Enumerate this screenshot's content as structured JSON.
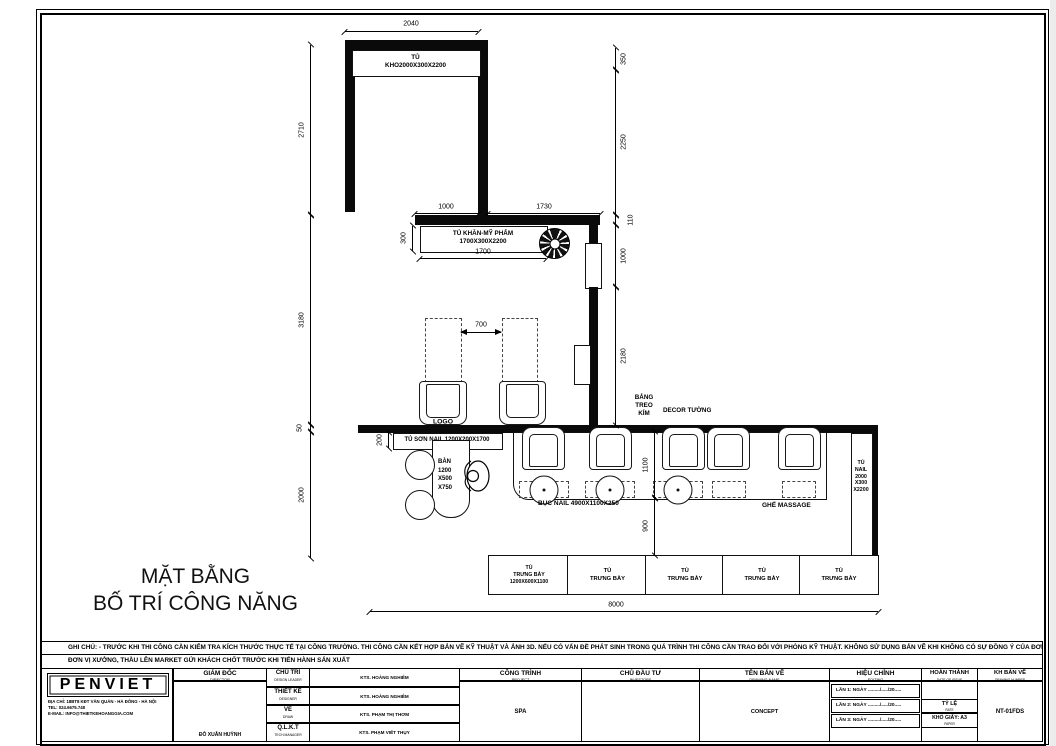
{
  "plan": {
    "title": {
      "l1": "MẶT BẰNG",
      "l2": "BỐ TRÍ CÔNG NĂNG"
    },
    "labels": {
      "storage_l1": "TỦ",
      "storage_l2": "KHO2000X300X2200",
      "towel_l1": "TỦ KHĂN-MỸ PHẨM",
      "towel_l2": "1700X300X2200",
      "logo": "LOGO",
      "board_l1": "BẢNG",
      "board_l2": "TREO",
      "board_l3": "KÍM",
      "decor": "DECOR TƯỜNG",
      "polish_cabinet": "TỦ SƠN NAIL 1200X200X1700",
      "table_l1": "BÀN",
      "table_l2": "1200",
      "table_l3": "X500",
      "table_l4": "X750",
      "platform": "BỤC NAIL 4900X1100X250",
      "massage": "GHẾ MASSAGE",
      "nailcab_l1": "TỦ",
      "nailcab_l2": "NAIL",
      "nailcab_l3": "2000",
      "nailcab_l4": "X300",
      "nailcab_l5": "X2200"
    },
    "display_cabinets": [
      {
        "l1": "TỦ",
        "l2": "TRƯNG BÀY",
        "l3": "1200X600X1100"
      },
      {
        "l1": "TỦ",
        "l2": "TRƯNG BÀY"
      },
      {
        "l1": "TỦ",
        "l2": "TRƯNG BÀY"
      },
      {
        "l1": "TỦ",
        "l2": "TRƯNG BÀY"
      },
      {
        "l1": "TỦ",
        "l2": "TRƯNG BÀY"
      }
    ],
    "dims": {
      "top_width": "2040",
      "top_wall_left": "1000",
      "top_wall_right": "1730",
      "left_chain": [
        "2710",
        "3180",
        "50",
        "2000"
      ],
      "right_chain": [
        "350",
        "2250",
        "110",
        "1000",
        "2180"
      ],
      "inner_chain": [
        "1100",
        "900"
      ],
      "bottom_width": "8000",
      "towel_depth": "300",
      "towel_width": "1700",
      "station_gap": "700",
      "polish_depth": "200"
    }
  },
  "notes": {
    "line1": "GHI CHÚ: - TRƯỚC KHI THI CÔNG CẦN KIỂM TRA KÍCH THƯỚC THỰC TẾ TẠI CÔNG TRƯỜNG.  THI CÔNG CẦN KẾT HỢP BẢN VẼ KỸ THUẬT VÀ ẢNH 3D. NẾU CÓ VẤN ĐỀ PHÁT SINH TRONG QUÁ TRÌNH THI CÔNG CẦN TRAO ĐỔI VỚI PHÒNG KỸ THUẬT. KHÔNG SỬ DỤNG BẢN VẼ KHI KHÔNG CÓ SỰ ĐỒNG Ý CỦA ĐƠN VỊ TƯ VẤN.",
    "line2": "ĐƠN VỊ XƯỞNG, THẦU LÊN MARKET GỬI KHÁCH CHỐT TRƯỚC KHI TIẾN HÀNH SẢN XUẤT"
  },
  "titleblock": {
    "company": {
      "name": "PENVIET",
      "address": "ĐỊA CHỈ: 18BT8 KĐT VĂN QUÁN - HÀ ĐÔNG - HÀ NỘI",
      "tel": "TEL:       024.6675.748",
      "email": "E-MAIL:  INFO@THIETKEHOANGGIA.COM"
    },
    "director": {
      "vi": "GIÁM ĐỐC",
      "en": "DIRECTOR",
      "name": "ĐỖ XUÂN HUỲNH"
    },
    "roles": [
      {
        "vi": "CHỦ TRÌ",
        "en": "DESIGN LEADER",
        "name": "KTS. HOÀNG NGHIÊM"
      },
      {
        "vi": "THIẾT KẾ",
        "en": "DESIGNER",
        "name": "KTS. HOÀNG NGHIÊM"
      },
      {
        "vi": "VẼ",
        "en": "DRAW",
        "name": "KTS. PHẠM THỊ THƠM"
      },
      {
        "vi": "Q.L.K.T",
        "en": "TECH.MANAGER",
        "name": "KTS. PHẠM VIẾT THỤY"
      }
    ],
    "project": {
      "vi": "CÔNG TRÌNH",
      "en": "PROJECT",
      "value": "SPA"
    },
    "investor": {
      "vi": "CHỦ ĐẦU TƯ",
      "en": "INVESTORS",
      "value": ""
    },
    "drawing_name": {
      "vi": "TÊN BẢN VẼ",
      "en": "DRAWING NAME",
      "value": "CONCEPT"
    },
    "editing": {
      "vi": "HIỆU CHỈNH",
      "en": "EDITING",
      "rows": [
        "LẦN 1: NGÀY ........./...../20.....",
        "LẦN 2: NGÀY ........./...../20.....",
        "LẦN 3: NGÀY ........./...../20....."
      ]
    },
    "completion": {
      "vi": "HOÀN THÀNH",
      "en": "DATE OF ISSUE",
      "scale_vi": "TỶ LỆ",
      "scale_en": "RATE",
      "paper_vi": "KHỔ GIẤY: A3",
      "paper_en": "PAPER"
    },
    "drawing_number": {
      "vi": "KH BẢN VẼ",
      "en": "DRAWING NUMBER",
      "value": "NT-01FDS"
    }
  }
}
